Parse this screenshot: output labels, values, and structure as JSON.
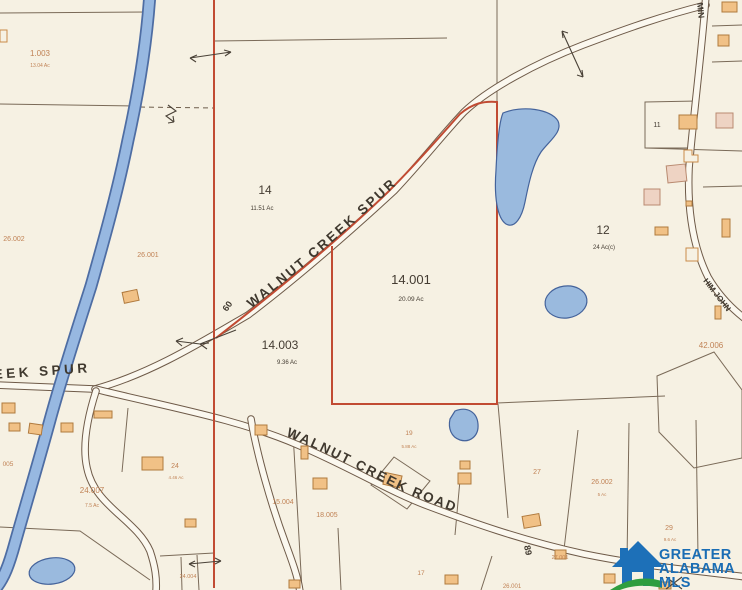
{
  "map": {
    "roads": {
      "spur": "WALNUT CREEK SPUR",
      "spur_west": "EEK SPUR",
      "road": "WALNUT CREEK ROAD",
      "min": "MIN",
      "him_john": "HIM JOHN",
      "route_60": "60",
      "route_89": "89"
    },
    "parcels": [
      {
        "id": "1.003",
        "ac": "13.04 Ac"
      },
      {
        "id": "14",
        "ac": "11.51 Ac"
      },
      {
        "id": "14.001",
        "ac": "20.09 Ac"
      },
      {
        "id": "14.003",
        "ac": "9.36 Ac"
      },
      {
        "id": "12",
        "ac": "24 Ac(c)"
      },
      {
        "id": "11",
        "ac": ""
      },
      {
        "id": "26.002",
        "ac": ""
      },
      {
        "id": "26.001",
        "ac": ""
      },
      {
        "id": "005",
        "ac": ""
      },
      {
        "id": "24.007",
        "ac": "7.5 Ac"
      },
      {
        "id": "24",
        "ac": "4.46 Ac"
      },
      {
        "id": "19",
        "ac": "5.88 Ac"
      },
      {
        "id": "15.004",
        "ac": ""
      },
      {
        "id": "18.005",
        "ac": ""
      },
      {
        "id": "27",
        "ac": ""
      },
      {
        "id": "26.002",
        "ac": "5 Ac"
      },
      {
        "id": "29",
        "ac": "9.6 Ac"
      },
      {
        "id": "42.006",
        "ac": ""
      },
      {
        "id": "27.001",
        "ac": ""
      },
      {
        "id": "24.004",
        "ac": ""
      },
      {
        "id": "17",
        "ac": ""
      },
      {
        "id": "26.001",
        "ac": ""
      }
    ],
    "highlighted_parcel": "14.001",
    "colors": {
      "highlight_boundary": "#c14b33",
      "water": "#97b8e1",
      "building": "#f1c186",
      "parcel_label_orange": "#c08255",
      "parcel_label_dark": "#443c32"
    }
  },
  "logo": {
    "line1": "GREATER",
    "line2": "ALABAMA",
    "line3": "MLS",
    "brand_blue": "#1a6db4",
    "brand_green": "#2f9e3f"
  }
}
